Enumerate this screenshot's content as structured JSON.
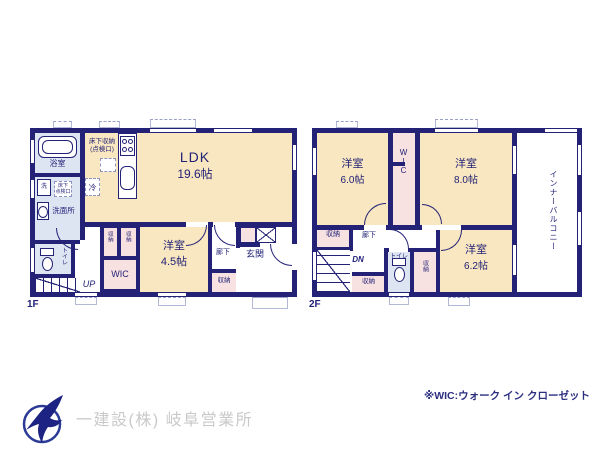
{
  "floor1": {
    "label": "1F",
    "ldk_name": "LDK",
    "ldk_area": "19.6帖",
    "bedroom_name": "洋室",
    "bedroom_area": "4.5帖",
    "bath": "浴室",
    "washroom": "洗面所",
    "washer": "洗",
    "fridge": "冷",
    "underfloor_storage": "床下収納\n(点検口)",
    "underfloor_hatch": "床下\n点検口",
    "toilet": "トイレ",
    "stairs": "UP",
    "wic": "WIC",
    "closet": "収納",
    "hall": "廊下",
    "entrance": "玄関"
  },
  "floor2": {
    "label": "2F",
    "bedroom1_name": "洋室",
    "bedroom1_area": "6.0帖",
    "bedroom2_name": "洋室",
    "bedroom2_area": "8.0帖",
    "bedroom3_name": "洋室",
    "bedroom3_area": "6.2帖",
    "wic": "WIC",
    "balcony": "インナーバルコニー",
    "closet": "収納",
    "hall": "廊下",
    "stairs": "DN",
    "toilet": "トイレ"
  },
  "footer": {
    "company": "一建設(株) 岐阜営業所",
    "note": "※WIC:ウォーク イン クローゼット"
  },
  "colors": {
    "wall": "#232277",
    "room_fill": "#f8e7c0",
    "wet_fill": "#dde5f2",
    "closet_fill": "#f8e1e1",
    "label_text": "#232277",
    "company_text": "#c9c9c9",
    "logo_blue": "#2b3a96"
  }
}
